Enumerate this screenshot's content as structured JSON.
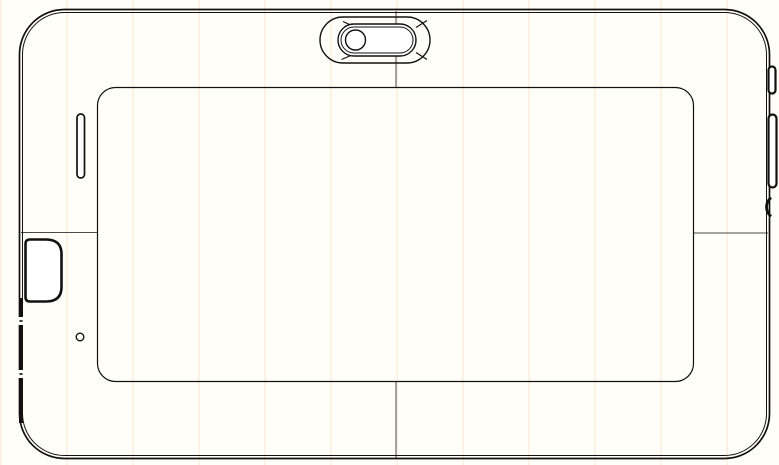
{
  "drawing": {
    "kind": "technical-line-drawing",
    "subject": "tablet-rear-view",
    "orientation": "landscape"
  },
  "palette": {
    "paper": "#fffef8",
    "paper-fill": "#ffffff",
    "line": "#111111",
    "seam": "#4a4a4a"
  },
  "components": {
    "device_body": "tablet rear housing with double contour outline",
    "battery_panel": "large rounded rear cover panel",
    "camera_module": "rear camera: stadium recess, pill bezel, round lens",
    "speaker_slot": "vertical speaker slot, upper left",
    "card_door": "card slot cover on left side",
    "left_edge_strip": "thick connector strip on lower left edge",
    "mic_hole": "microphone pinhole, lower left",
    "power_button": "short button on upper right edge",
    "volume_rocker": "long rocker button on right edge",
    "edge_notch": "small notch on right edge",
    "seam_lines": "panel parting seam lines (top, bottom, left, right)"
  }
}
